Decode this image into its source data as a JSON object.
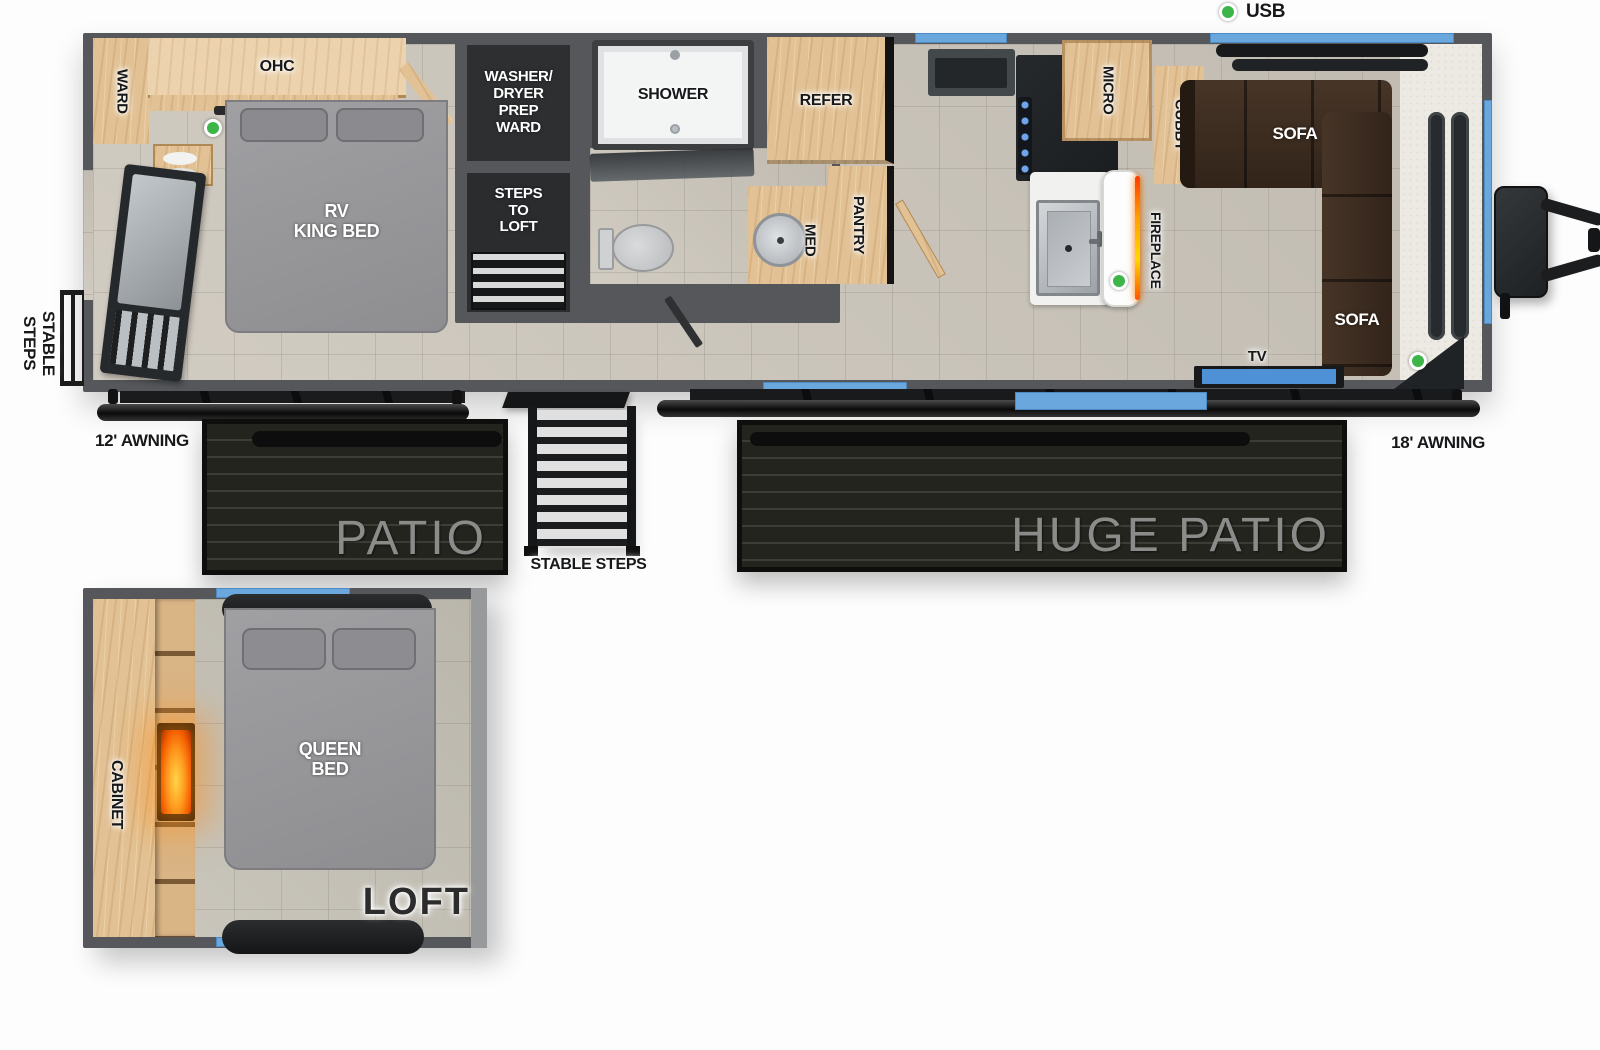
{
  "legend": {
    "usb": "USB"
  },
  "main": {
    "ward": "WARD",
    "ohc": "OHC",
    "king_bed": "RV\nKING BED",
    "washer": "WASHER/\nDRYER\nPREP\nWARD",
    "steps_to_loft": "STEPS\nTO\nLOFT",
    "shower": "SHOWER",
    "med": "MED",
    "pantry": "PANTRY",
    "refer": "REFER",
    "micro": "MICRO",
    "cubby": "CUBBY",
    "fireplace": "FIREPLACE",
    "sofa_top": "SOFA",
    "sofa_side": "SOFA",
    "tv": "TV"
  },
  "exterior": {
    "rear_steps": "STABLE STEPS",
    "awning_left": "12' AWNING",
    "awning_right": "18' AWNING",
    "patio": "PATIO",
    "center_steps": "STABLE STEPS",
    "huge_patio": "HUGE PATIO"
  },
  "loft": {
    "cabinet": "CABINET",
    "queen_bed": "QUEEN\nBED",
    "name": "LOFT"
  },
  "colors": {
    "accent_blue": "#6aa7dc",
    "usb_green": "#3db549",
    "wood": "#e2c295",
    "wall_gray": "#55575a",
    "sofa_brown": "#3a2b20"
  }
}
